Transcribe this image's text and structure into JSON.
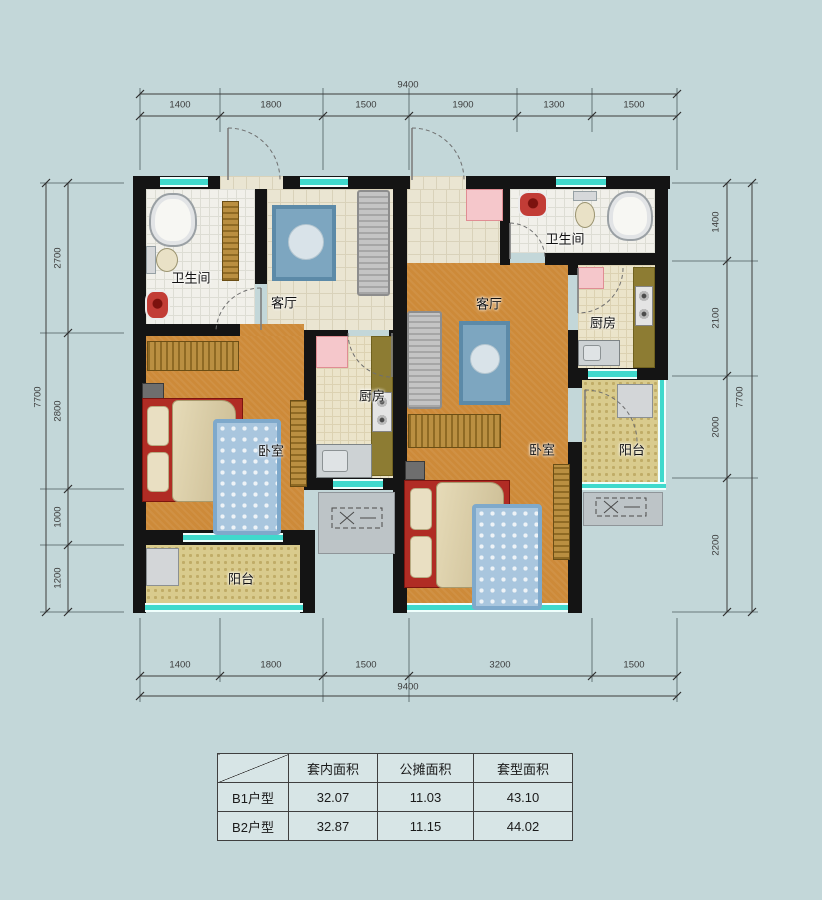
{
  "plan": {
    "units": {
      "b1": {
        "rooms": {
          "living": "客厅",
          "bedroom": "卧室",
          "kitchen": "厨房",
          "bathroom": "卫生间",
          "balcony": "阳台"
        }
      },
      "b2": {
        "rooms": {
          "living": "客厅",
          "bedroom": "卧室",
          "kitchen": "厨房",
          "bathroom": "卫生间",
          "balcony": "阳台"
        }
      }
    },
    "dimensions": {
      "top": {
        "overall": "9400",
        "segments": [
          "1400",
          "1800",
          "1500",
          "1900",
          "1300",
          "1500"
        ]
      },
      "bottom": {
        "overall": "9400",
        "segments": [
          "1400",
          "1800",
          "1500",
          "3200",
          "1500"
        ]
      },
      "left": {
        "overall": "7700",
        "segments": [
          "2700",
          "2800",
          "1000",
          "1200"
        ]
      },
      "right": {
        "overall": "7700",
        "segments": [
          "1400",
          "2100",
          "2000",
          "2200"
        ]
      }
    }
  },
  "table": {
    "headers": [
      "套内面积",
      "公摊面积",
      "套型面积"
    ],
    "rows": [
      {
        "label": "B1户型",
        "values": [
          "32.07",
          "11.03",
          "43.10"
        ]
      },
      {
        "label": "B2户型",
        "values": [
          "32.87",
          "11.15",
          "44.02"
        ]
      }
    ]
  },
  "colors": {
    "background": "#c3d7d9",
    "wall": "#141414",
    "window_teal": "#3fd9cc",
    "floor_orange": "#cd8a39",
    "floor_tile_beige": "#eae5d2",
    "floor_balcony_yellow": "#d9cb8d",
    "counter_olive": "#8d7c33",
    "cabinet_pink": "#f5c7cb",
    "bed_red": "#b02c24",
    "rug_blue": "#7da6c0"
  }
}
